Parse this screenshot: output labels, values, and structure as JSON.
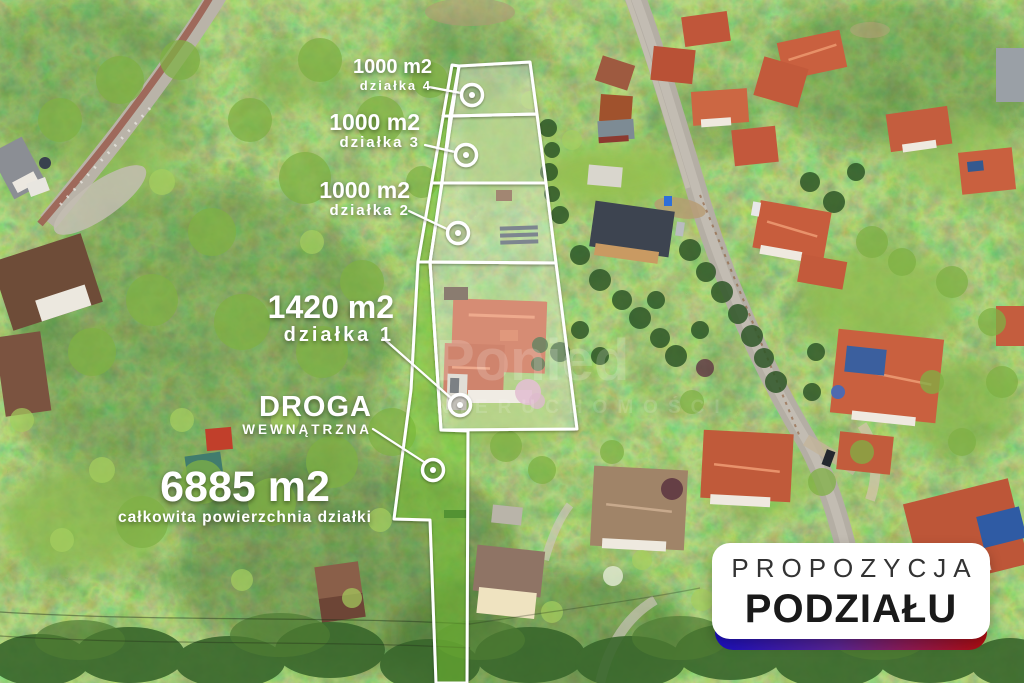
{
  "annotations": {
    "plots": [
      {
        "area": "1000 m2",
        "label": "działka 4"
      },
      {
        "area": "1000 m2",
        "label": "działka 3"
      },
      {
        "area": "1000 m2",
        "label": "działka 2"
      },
      {
        "area": "1420 m2",
        "label": "działka 1"
      }
    ],
    "road": {
      "title": "DROGA",
      "subtitle": "WEWNĄTRZNA"
    },
    "total": {
      "area": "6885 m2",
      "caption": "całkowita powierzchnia działki"
    }
  },
  "badge": {
    "line1": "PROPOZYCJA",
    "line2": "PODZIAŁU"
  },
  "watermark": {
    "line1": "Ponied",
    "line2": "NIERUCHOMOŚCI"
  },
  "colors": {
    "outline": "#ffffff",
    "plot_fill": "rgba(255,255,255,0.30)",
    "road_fill": "rgba(120,195,50,0.50)",
    "badge_gradient_left": "#1c10c0",
    "badge_gradient_right": "#b00d10"
  }
}
